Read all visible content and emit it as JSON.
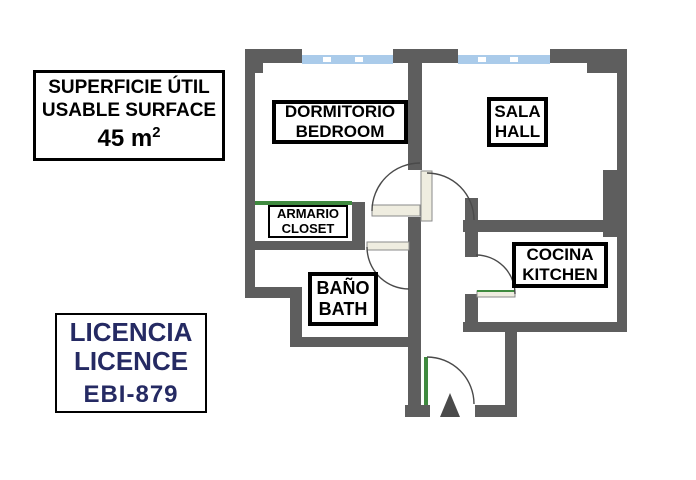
{
  "surface_box": {
    "line1": "SUPERFICIE ÚTIL",
    "line2": "USABLE SURFACE",
    "area_value": "45 m",
    "area_sup": "2"
  },
  "licence_box": {
    "line1": "LICENCIA",
    "line2": "LICENCE",
    "code": "EBI-879"
  },
  "rooms": {
    "bedroom": {
      "es": "DORMITORIO",
      "en": "BEDROOM"
    },
    "hall": {
      "es": "SALA",
      "en": "HALL"
    },
    "closet": {
      "es": "ARMARIO",
      "en": "CLOSET"
    },
    "bath": {
      "es": "BAÑO",
      "en": "BATH"
    },
    "kitchen": {
      "es": "COCINA",
      "en": "KITCHEN"
    }
  },
  "colors": {
    "wall": "#5e5e5e",
    "window_glass": "#aacbea",
    "door_leaf": "#efede0",
    "door_green": "#3f8a3f",
    "door_arc": "#4a4a4a",
    "entrance_marker": "#4a4a4a",
    "licence_text": "#252a63",
    "label_text": "#000000"
  }
}
